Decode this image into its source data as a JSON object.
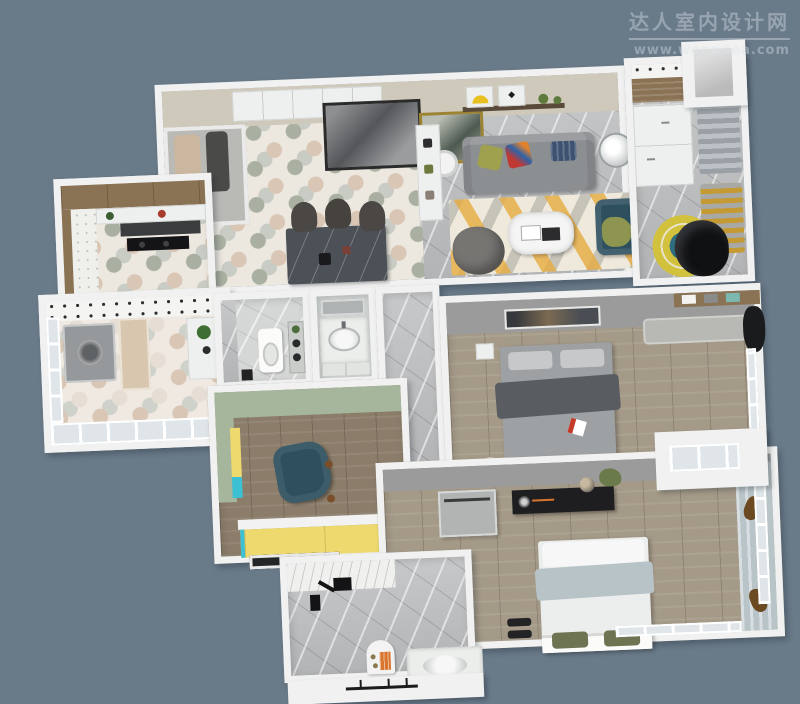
{
  "watermark": {
    "title": "达人室内设计网",
    "url": "www.wonadea.com"
  },
  "scene": {
    "type": "3d-floor-plan-render",
    "view": "top-down axonometric apartment rendering",
    "rooms": [
      "entry",
      "dining",
      "living-room",
      "kitchen",
      "balcony-laundry",
      "bathroom",
      "vanity-bathroom",
      "hallway",
      "kids-room",
      "walk-in-closet",
      "master-bedroom",
      "second-bedroom",
      "study-bathroom"
    ]
  },
  "palette": {
    "bg": "#697a89",
    "wm": "rgba(222,231,238,0.40)",
    "wall-white": "#f0f1f0",
    "beige-wall": "#cfc9bb",
    "gray-wall": "#9b9b9b",
    "sage": "#a6b69c",
    "hex-bg": "#ece8e0",
    "hex-a": "#aab0a1",
    "hex-b": "#dac6b4",
    "hex-c": "#c8ccc4",
    "hex-warm-bg": "#efe9e2",
    "hex-warm-a": "#d9c6b4",
    "hex-warm-b": "#e6ded4",
    "hex-warm-c": "#cfd2ca",
    "marble": "#bdbfc1",
    "marble-light": "#d4d7d5",
    "wood": "#a59a88",
    "wood-dark": "#8b7d6a",
    "wood-cab": "#8a7254",
    "sofa": "#8c8f92",
    "olive": "#9fa14e",
    "navy": "#3c5270",
    "teal-chair": "#2d4f5e",
    "bean": "#777572",
    "yellow-wardrobe": "#eed96e",
    "teal-edge": "#3cc0d4",
    "curtain": "#b8c4c8",
    "console-black": "#1e1e20",
    "throw-blue": "#b7c3c7",
    "pillow-olive": "#6e7452",
    "orange": "#d9752e",
    "glass": "#dfe5e8",
    "gold": "#9c8434",
    "egg-black": "#101113",
    "rug-ring-yellow": "#d2c13c",
    "rug-ring-teal": "#2e6e80",
    "bed-gray": "#9ea1a3",
    "blanket": "#595c60",
    "red-accent": "#c43b2a"
  }
}
